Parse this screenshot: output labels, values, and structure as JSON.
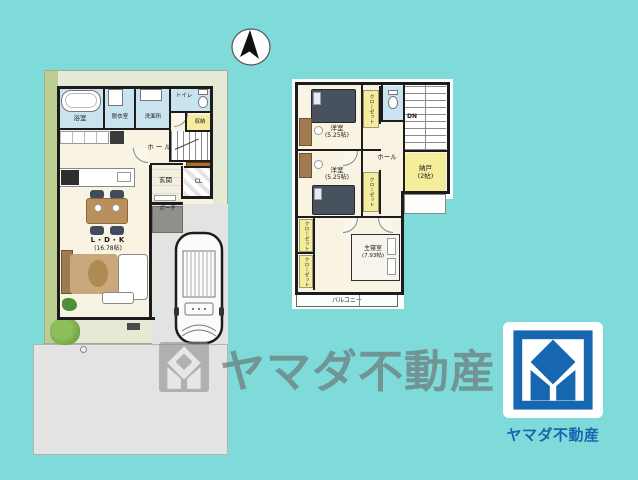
{
  "colors": {
    "background_teal": "#7EDBD9",
    "wall": "#1C1C1C",
    "room_cream": "#F8F3E2",
    "wet_area_blue": "#C9E4EF",
    "storage_yellow": "#F5EC9C",
    "logo_blue": "#1766B0",
    "lawn_green": "#BCCE92",
    "driveway_gray": "#E3E3E1"
  },
  "floor1": {
    "bath": "浴室",
    "dressing": "脱衣室",
    "washroom": "洗面所",
    "toilet": "トイレ",
    "storage": "収納",
    "hall": "ホール",
    "entrance": "玄関",
    "closet": "CL",
    "porch": "ポーチ",
    "ldk": "L・D・K",
    "ldk_size": "(16.78帖)"
  },
  "floor2": {
    "bedroom1": "洋室",
    "bedroom1_size": "(5.25帖)",
    "bedroom2": "洋室",
    "bedroom2_size": "(5.25帖)",
    "master_bedroom": "主寝室",
    "master_bedroom_size": "(7.93帖)",
    "toilet": "トイレ",
    "stairs_down": "DN",
    "storage_room": "納戸",
    "storage_room_size": "(2帖)",
    "hall": "ホール",
    "closet": "クローゼット",
    "balcony": "バルコニー"
  },
  "watermark": {
    "text": "ヤマダ不動産"
  },
  "logo": {
    "company": "ヤマダ不動産"
  }
}
